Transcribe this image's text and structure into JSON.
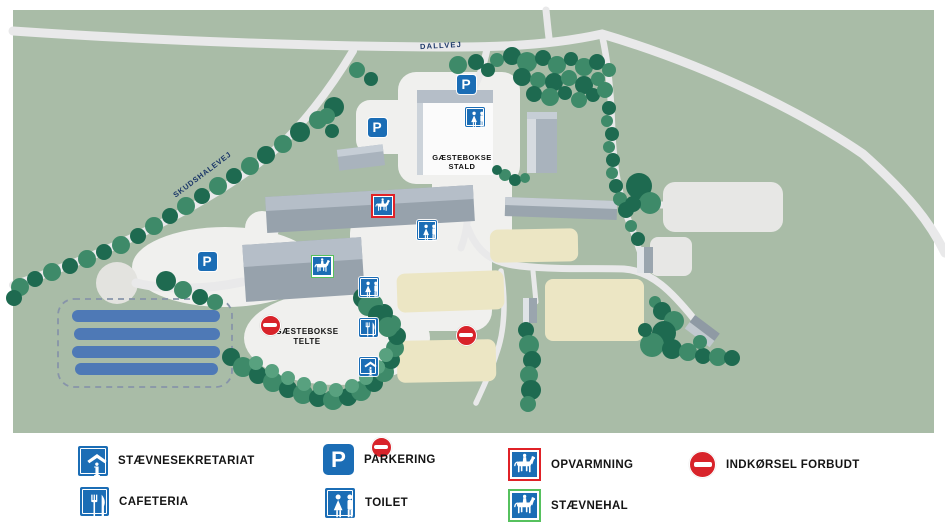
{
  "map": {
    "road_labels": [
      {
        "id": "dallvej",
        "text": "DALLVEJ"
      },
      {
        "id": "skudshalevej",
        "text": "SKUDSHALEVEJ"
      }
    ],
    "area_labels": [
      {
        "id": "gaestebokse-stald",
        "line1": "GÆSTEBOKSE",
        "line2": "STALD"
      },
      {
        "id": "gaestebokse-telte",
        "line1": "GÆSTEBOKSE",
        "line2": "TELTE"
      }
    ],
    "markers": [
      {
        "type": "parking",
        "x": 466,
        "y": 84
      },
      {
        "type": "parking",
        "x": 377,
        "y": 127
      },
      {
        "type": "parking",
        "x": 207,
        "y": 261
      },
      {
        "type": "toilet",
        "x": 475,
        "y": 117
      },
      {
        "type": "toilet",
        "x": 427,
        "y": 210
      },
      {
        "type": "toilet",
        "x": 369,
        "y": 247
      },
      {
        "type": "cafeteria",
        "x": 368,
        "y": 267
      },
      {
        "type": "info",
        "x": 368,
        "y": 287
      },
      {
        "type": "opvarmning",
        "x": 383,
        "y": 206
      },
      {
        "type": "staevnehal",
        "x": 322,
        "y": 266
      },
      {
        "type": "no-entry",
        "x": 270,
        "y": 227
      },
      {
        "type": "no-entry",
        "x": 466,
        "y": 216
      },
      {
        "type": "no-entry",
        "x": 381,
        "y": 307
      }
    ]
  },
  "legend": {
    "items": [
      {
        "icon": "info",
        "label": "STÆVNESEKRETARIAT"
      },
      {
        "icon": "parking",
        "label": "PARKERING"
      },
      {
        "icon": "opvarmning",
        "label": "OPVARMNING"
      },
      {
        "icon": "no-entry",
        "label": "INDKØRSEL FORBUDT"
      },
      {
        "icon": "cafeteria",
        "label": "CAFETERIA"
      },
      {
        "icon": "toilet",
        "label": "TOILET"
      },
      {
        "icon": "staevnehal",
        "label": "STÆVNEHAL"
      }
    ]
  },
  "colors": {
    "map_green": "#a9bca7",
    "road": "#e9e9ea",
    "paved": "#f0f0ee",
    "culdesac": "#e3e3df",
    "tree_dark": "#1e6a50",
    "tree_mid": "#3e8a69",
    "tree_light": "#58a17f",
    "building_face": "#97a2ac",
    "building_top": "#b5bec8",
    "stall_white": "#fbfbfb",
    "field_beige": "#ece6c4",
    "lot_gray": "#e7e7e5",
    "sign_blue": "#1b6db5",
    "no_entry_red": "#d8232a",
    "frame_red": "#e02127",
    "frame_green": "#56c15e",
    "parking_bar_blue": "#4e79b6",
    "label_navy": "#1b3768"
  }
}
